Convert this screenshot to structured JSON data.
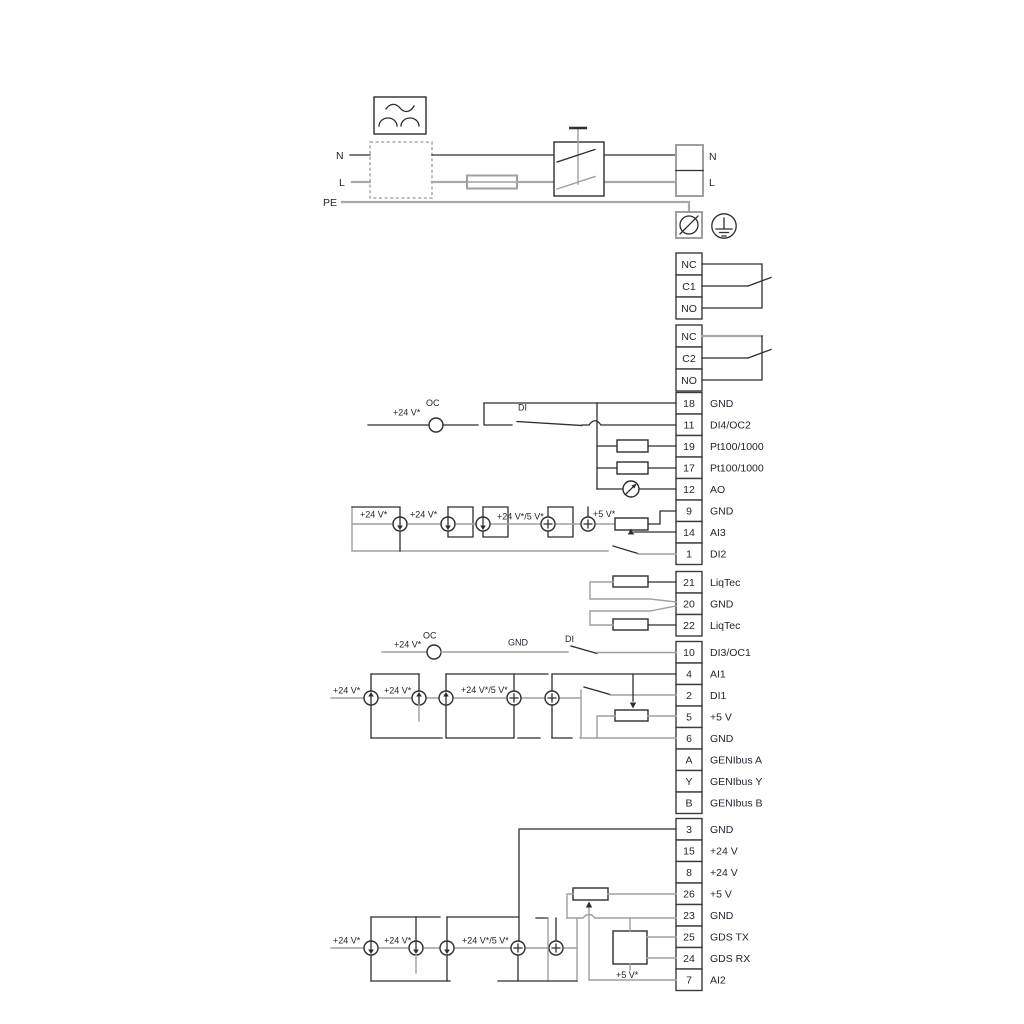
{
  "labels": {
    "v24": "+24 V*",
    "v24_5": "+24 V*/5 V*",
    "v5": "+5 V*",
    "oc": "OC",
    "di": "DI",
    "gnd": "GND",
    "n": "N",
    "l": "L",
    "pe": "PE"
  },
  "relay1": {
    "nc": "NC",
    "c": "C1",
    "no": "NO"
  },
  "relay2": {
    "nc": "NC",
    "c": "C2",
    "no": "NO"
  },
  "terminals": {
    "g1": [
      {
        "num": "18",
        "label": "GND"
      },
      {
        "num": "11",
        "label": "DI4/OC2"
      },
      {
        "num": "19",
        "label": "Pt100/1000"
      },
      {
        "num": "17",
        "label": "Pt100/1000"
      },
      {
        "num": "12",
        "label": "AO"
      },
      {
        "num": "9",
        "label": "GND"
      },
      {
        "num": "14",
        "label": "AI3"
      },
      {
        "num": "1",
        "label": "DI2"
      }
    ],
    "g2": [
      {
        "num": "21",
        "label": "LiqTec"
      },
      {
        "num": "20",
        "label": "GND"
      },
      {
        "num": "22",
        "label": "LiqTec"
      }
    ],
    "g3": [
      {
        "num": "10",
        "label": "DI3/OC1"
      },
      {
        "num": "4",
        "label": "AI1"
      },
      {
        "num": "2",
        "label": "DI1"
      },
      {
        "num": "5",
        "label": "+5 V"
      },
      {
        "num": "6",
        "label": "GND"
      },
      {
        "num": "A",
        "label": "GENIbus A"
      },
      {
        "num": "Y",
        "label": "GENIbus Y"
      },
      {
        "num": "B",
        "label": "GENIbus B"
      }
    ],
    "g4": [
      {
        "num": "3",
        "label": "GND"
      },
      {
        "num": "15",
        "label": "+24 V"
      },
      {
        "num": "8",
        "label": "+24 V"
      },
      {
        "num": "26",
        "label": "+5 V"
      },
      {
        "num": "23",
        "label": "GND"
      },
      {
        "num": "25",
        "label": "GDS TX"
      },
      {
        "num": "24",
        "label": "GDS RX"
      },
      {
        "num": "7",
        "label": "AI2"
      }
    ]
  },
  "colors": {
    "line_dark": "#2e2e2e",
    "line_gray": "#a0a0a0",
    "text": "#23242e",
    "background": "#ffffff"
  }
}
